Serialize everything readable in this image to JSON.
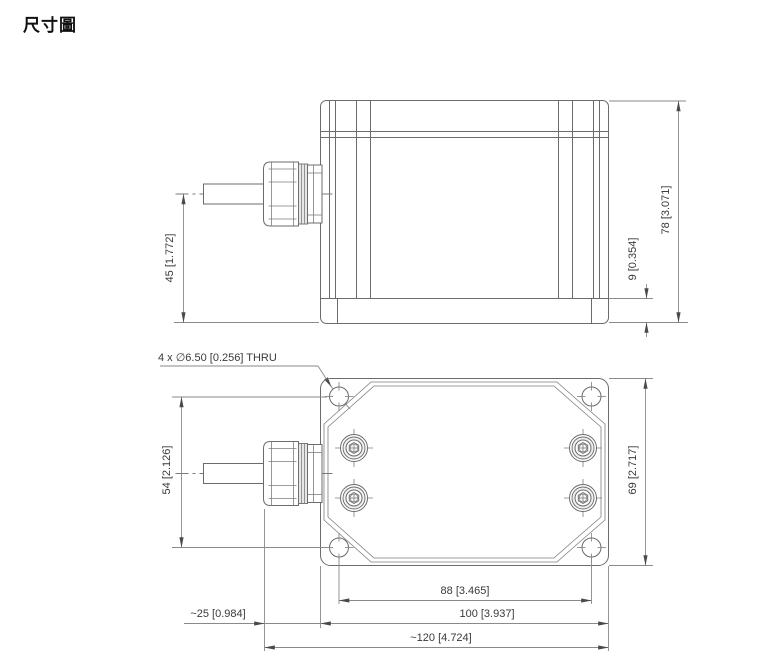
{
  "title": "尺寸圖",
  "callout": {
    "hole_note": "4 x ∅6.50 [0.256]  THRU"
  },
  "dims": {
    "cable_to_base": {
      "label": "45 [1.772]",
      "mm": "45",
      "inch": "1.772"
    },
    "base_step": {
      "label": "9 [0.354]",
      "mm": "9",
      "inch": "0.354"
    },
    "overall_height": {
      "label": "78 [3.071]",
      "mm": "78",
      "inch": "3.071"
    },
    "hole_pitch_vertical": {
      "label": "54 [2.126]",
      "mm": "54",
      "inch": "2.126"
    },
    "body_depth": {
      "label": "69 [2.717]",
      "mm": "69",
      "inch": "2.717"
    },
    "hole_pitch_horizontal": {
      "label": "88 [3.465]",
      "mm": "88",
      "inch": "3.465"
    },
    "gland_protrusion": {
      "label": "~25 [0.984]",
      "mm": "25",
      "inch": "0.984"
    },
    "body_width": {
      "label": "100 [3.937]",
      "mm": "100",
      "inch": "3.937"
    },
    "overall_width": {
      "label": "~120 [4.724]",
      "mm": "120",
      "inch": "4.724"
    }
  },
  "colors": {
    "object_line": "#6b6b6b",
    "dimension_line": "#8a8a8a",
    "text": "#3a3a3a",
    "title_text": "#111111",
    "background": "#ffffff"
  }
}
